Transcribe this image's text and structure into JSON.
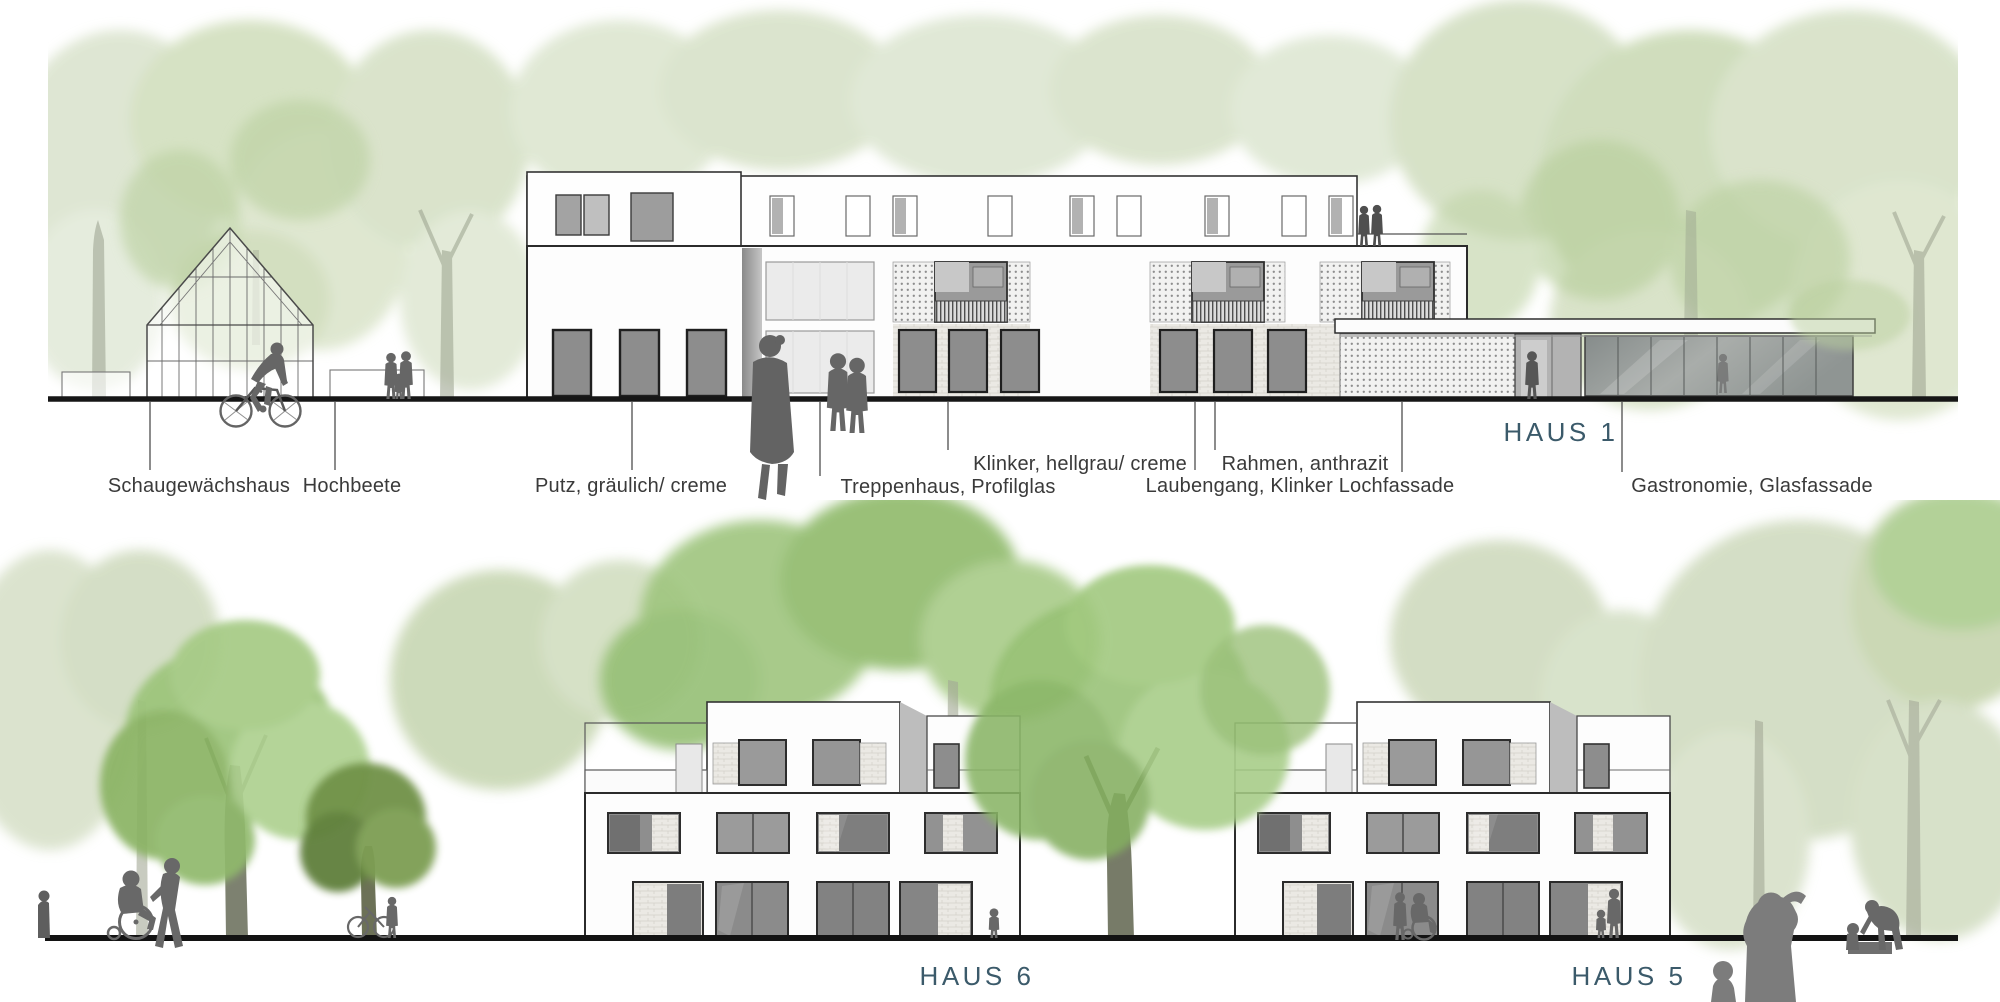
{
  "palette": {
    "haus_label_color": "#3b5a6a",
    "annotation_color": "#3a3a3a",
    "silhouette_gray": "#6b6b6b",
    "foliage_green": "#8db868",
    "pale_foliage": "#ccdcbc",
    "ground_line_color": "#141414"
  },
  "top_elevation": {
    "haus_label": "HAUS 1",
    "annotations": {
      "schaugewaechshaus": "Schaugewächshaus",
      "hochbeete": "Hochbeete",
      "putz": "Putz, gräulich/ creme",
      "treppenhaus": "Treppenhaus, Profilglas",
      "klinker": "Klinker, hellgrau/ creme",
      "rahmen": "Rahmen, anthrazit",
      "laubengang": "Laubengang, Klinker Lochfassade",
      "gastronomie": "Gastronomie, Glasfassade"
    },
    "figures": [
      "cyclist",
      "couple with child",
      "walking woman",
      "pedestrian couple",
      "couple on roof terrace",
      "person at entrance",
      "person in glass pavilion"
    ]
  },
  "bottom_elevation": {
    "haus_6_label": "HAUS 6",
    "haus_5_label": "HAUS 5",
    "figures": [
      "person pushing wheelchair",
      "person walking bicycle",
      "child",
      "wheelchair pair",
      "adult with child",
      "foreground adult",
      "foreground child",
      "adult bending over child at sandbox"
    ]
  }
}
